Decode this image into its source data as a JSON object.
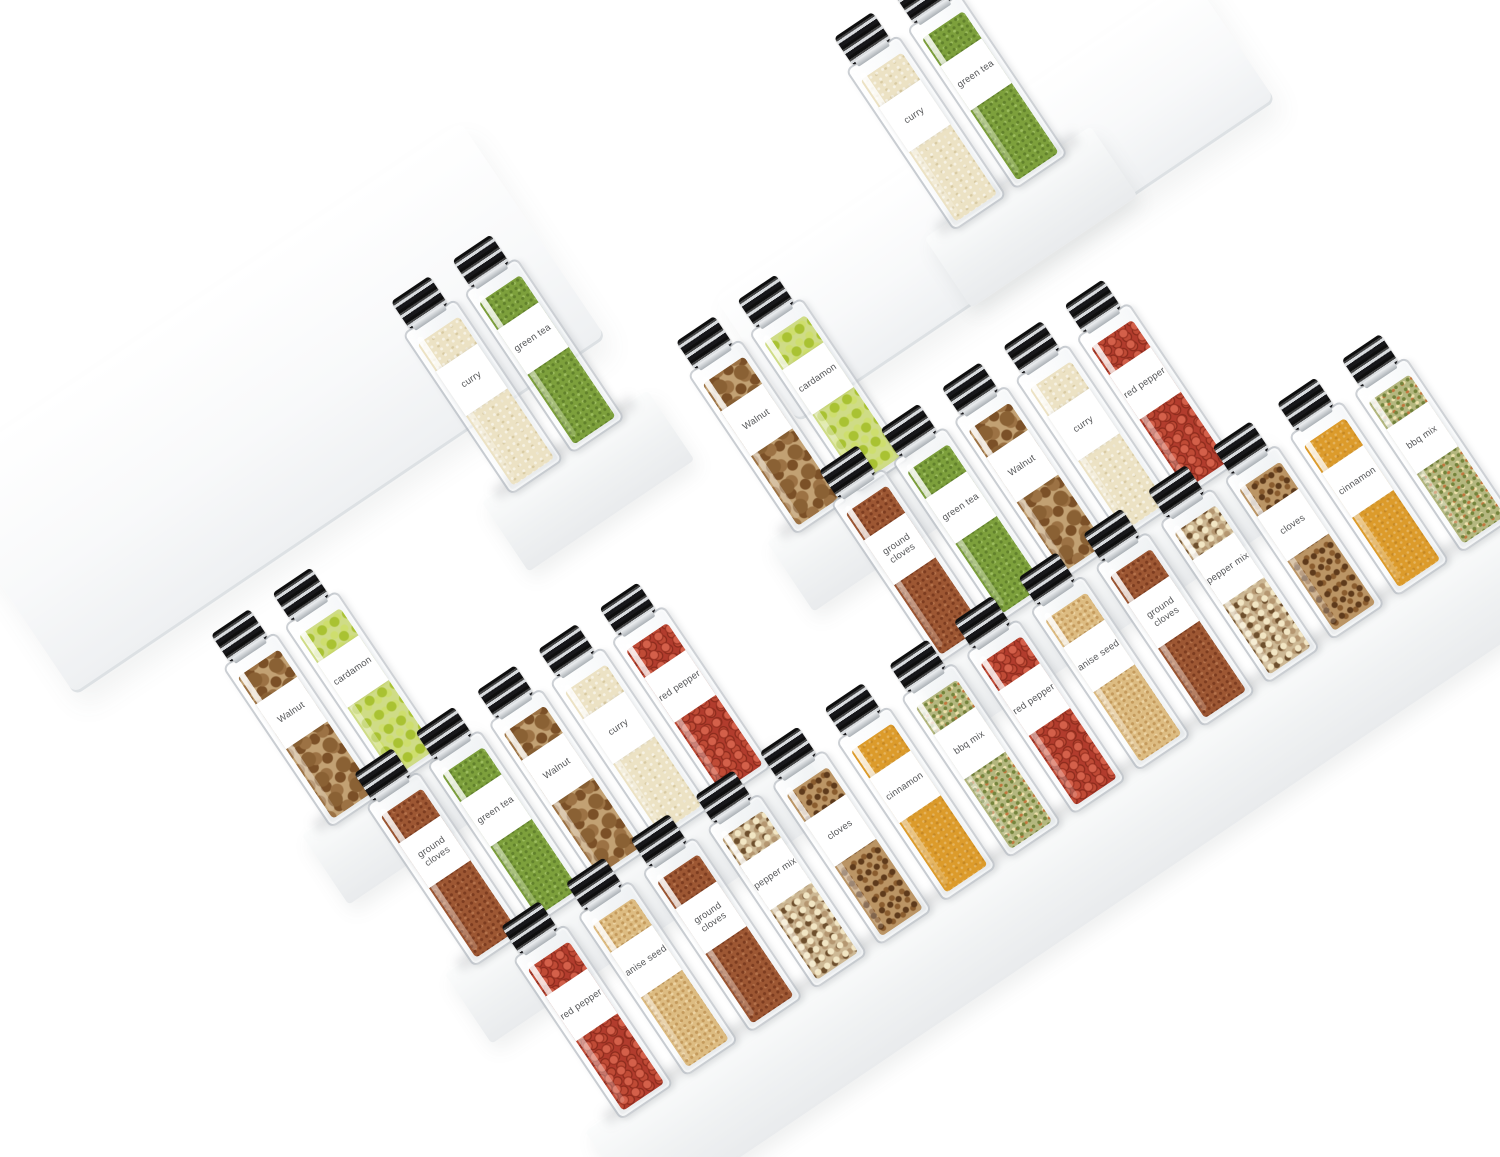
{
  "scene": {
    "description": "Two tiered clear acrylic spice-rack shelf organizers photographed diagonally on white, holding 32 square glass spice jars with black-and-silver caps and white printed labels",
    "background": "#ffffff"
  },
  "palette": {
    "label_bg": "#ffffff",
    "label_text": "#57585a",
    "cap_dark": "#141414",
    "cap_silver": "#d8dbde",
    "glass_border": "#949ca3",
    "shelf": "#f0f2f3"
  },
  "spices": {
    "curry": {
      "label": "curry",
      "color": "#ece2c4"
    },
    "green_tea": {
      "label": "green tea",
      "color": "#7da03c"
    },
    "walnut": {
      "label": "Walnut",
      "color": "#c2a173"
    },
    "cardamon": {
      "label": "cardamon",
      "color": "#cfdc86"
    },
    "ground_cloves": {
      "label": "ground cloves",
      "color": "#9d5733"
    },
    "red_pepper": {
      "label": "red pepper",
      "color": "#b23c2d"
    },
    "anise_seed": {
      "label": "anise seed",
      "color": "#ddbc82"
    },
    "pepper_mix": {
      "label": "pepper mix",
      "color": "#cdb894"
    },
    "cloves": {
      "label": "cloves",
      "color": "#bb9565"
    },
    "cinnamon": {
      "label": "cinnamon",
      "color": "#dc9b2b"
    },
    "bbq_mix": {
      "label": "bbq mix",
      "color": "#b4b77f"
    }
  },
  "rows": [
    {
      "name": "top-right-pair",
      "x": 845,
      "y": 70,
      "jars": [
        "curry",
        "green_tea"
      ]
    },
    {
      "name": "upper-left-pair",
      "x": 402,
      "y": 334,
      "jars": [
        "curry",
        "green_tea"
      ]
    },
    {
      "name": "right-back-pair",
      "x": 687,
      "y": 374,
      "jars": [
        "walnut",
        "cardamon"
      ]
    },
    {
      "name": "right-middle-row",
      "x": 830,
      "y": 503,
      "jars": [
        "ground_cloves",
        "green_tea",
        "walnut",
        "curry",
        "red_pepper"
      ]
    },
    {
      "name": "left-back-pair",
      "x": 222,
      "y": 667,
      "jars": [
        "walnut",
        "cardamon"
      ]
    },
    {
      "name": "left-middle-row",
      "x": 365,
      "y": 806,
      "jars": [
        "ground_cloves",
        "green_tea",
        "walnut",
        "curry",
        "red_pepper"
      ]
    },
    {
      "name": "front-row",
      "x": 512,
      "y": 959,
      "jars": [
        "red_pepper",
        "anise_seed",
        "ground_cloves",
        "pepper_mix",
        "cloves",
        "cinnamon",
        "bbq_mix",
        "red_pepper",
        "anise_seed",
        "ground_cloves",
        "pepper_mix",
        "cloves",
        "cinnamon",
        "bbq_mix"
      ]
    }
  ]
}
